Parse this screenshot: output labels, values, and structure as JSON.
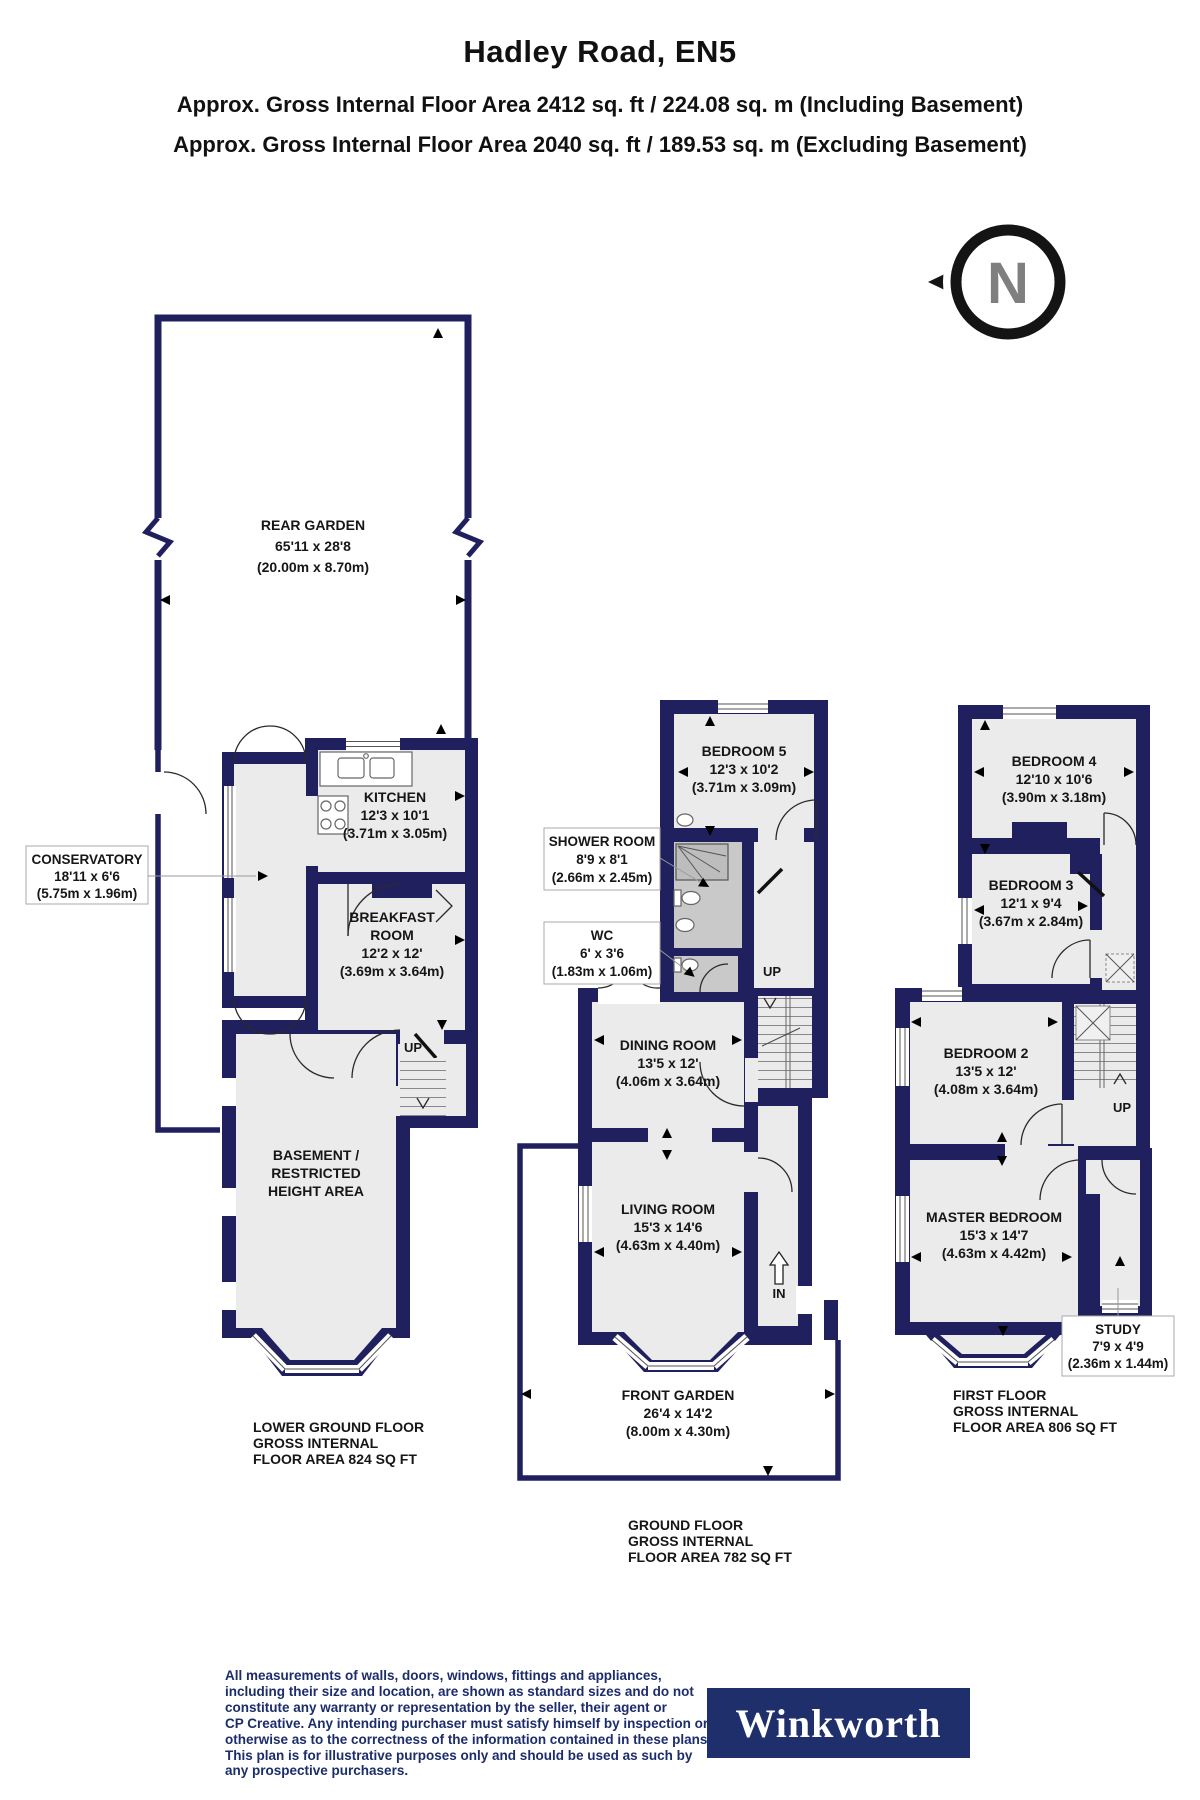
{
  "header": {
    "title": "Hadley Road, EN5",
    "subtitle1": "Approx. Gross Internal Floor Area 2412 sq. ft / 224.08 sq. m (Including Basement)",
    "subtitle2": "Approx. Gross Internal Floor Area 2040 sq. ft / 189.53 sq. m (Excluding Basement)"
  },
  "compass": {
    "label": "N"
  },
  "colors": {
    "wall_navy": "#20205e",
    "room_fill": "#ebebeb",
    "wet_room_fill": "#c9c9c9",
    "navy_text": "#1c2d6b",
    "logo_background": "#1e2f6b"
  },
  "lower_ground": {
    "rear_garden": {
      "lines": [
        "REAR GARDEN",
        "65'11 x 28'8",
        "(20.00m x 8.70m)"
      ]
    },
    "kitchen": {
      "lines": [
        "KITCHEN",
        "12'3 x 10'1",
        "(3.71m x 3.05m)"
      ]
    },
    "conservatory": {
      "lines": [
        "CONSERVATORY",
        "18'11 x 6'6",
        "(5.75m x 1.96m)"
      ]
    },
    "breakfast_room": {
      "lines": [
        "BREAKFAST",
        "ROOM",
        "12'2 x 12'",
        "(3.69m x 3.64m)"
      ]
    },
    "basement": {
      "lines": [
        "BASEMENT /",
        "RESTRICTED",
        "HEIGHT AREA"
      ]
    },
    "stairs_label": "UP",
    "caption": {
      "lines": [
        "LOWER GROUND FLOOR",
        "GROSS INTERNAL",
        "FLOOR AREA 824 SQ FT"
      ]
    }
  },
  "ground": {
    "bedroom5": {
      "lines": [
        "BEDROOM 5",
        "12'3 x 10'2",
        "(3.71m x 3.09m)"
      ]
    },
    "shower_room": {
      "lines": [
        "SHOWER ROOM",
        "8'9 x 8'1",
        "(2.66m x 2.45m)"
      ]
    },
    "wc": {
      "lines": [
        "WC",
        "6' x 3'6",
        "(1.83m x 1.06m)"
      ]
    },
    "dining_room": {
      "lines": [
        "DINING ROOM",
        "13'5 x 12'",
        "(4.06m x 3.64m)"
      ]
    },
    "living_room": {
      "lines": [
        "LIVING ROOM",
        "15'3 x 14'6",
        "(4.63m x 4.40m)"
      ]
    },
    "front_garden": {
      "lines": [
        "FRONT GARDEN",
        "26'4 x 14'2",
        "(8.00m x 4.30m)"
      ]
    },
    "stairs_label": "UP",
    "entrance_label": "IN",
    "caption": {
      "lines": [
        "GROUND FLOOR",
        "GROSS INTERNAL",
        "FLOOR AREA 782 SQ FT"
      ]
    }
  },
  "first": {
    "bedroom4": {
      "lines": [
        "BEDROOM 4",
        "12'10 x 10'6",
        "(3.90m x 3.18m)"
      ]
    },
    "bedroom3": {
      "lines": [
        "BEDROOM 3",
        "12'1 x 9'4",
        "(3.67m x 2.84m)"
      ]
    },
    "bedroom2": {
      "lines": [
        "BEDROOM 2",
        "13'5 x 12'",
        "(4.08m x 3.64m)"
      ]
    },
    "master_bedroom": {
      "lines": [
        "MASTER BEDROOM",
        "15'3 x 14'7",
        "(4.63m x 4.42m)"
      ]
    },
    "study": {
      "lines": [
        "STUDY",
        "7'9 x 4'9",
        "(2.36m x 1.44m)"
      ]
    },
    "stairs_label": "UP",
    "caption": {
      "lines": [
        "FIRST FLOOR",
        "GROSS INTERNAL",
        "FLOOR AREA 806 SQ FT"
      ]
    }
  },
  "footer": {
    "disclaimer_lines": [
      "All measurements of walls, doors, windows, fittings and appliances,",
      "including their size and location, are shown as standard sizes and do not",
      "constitute any warranty or representation by the seller, their agent or",
      "CP Creative. Any intending purchaser must satisfy himself by inspection or",
      "otherwise as to the correctness of the information contained in these plans.",
      "This plan is for illustrative purposes only and should be used as such by",
      "any prospective purchasers."
    ],
    "logo_text": "Winkworth"
  }
}
